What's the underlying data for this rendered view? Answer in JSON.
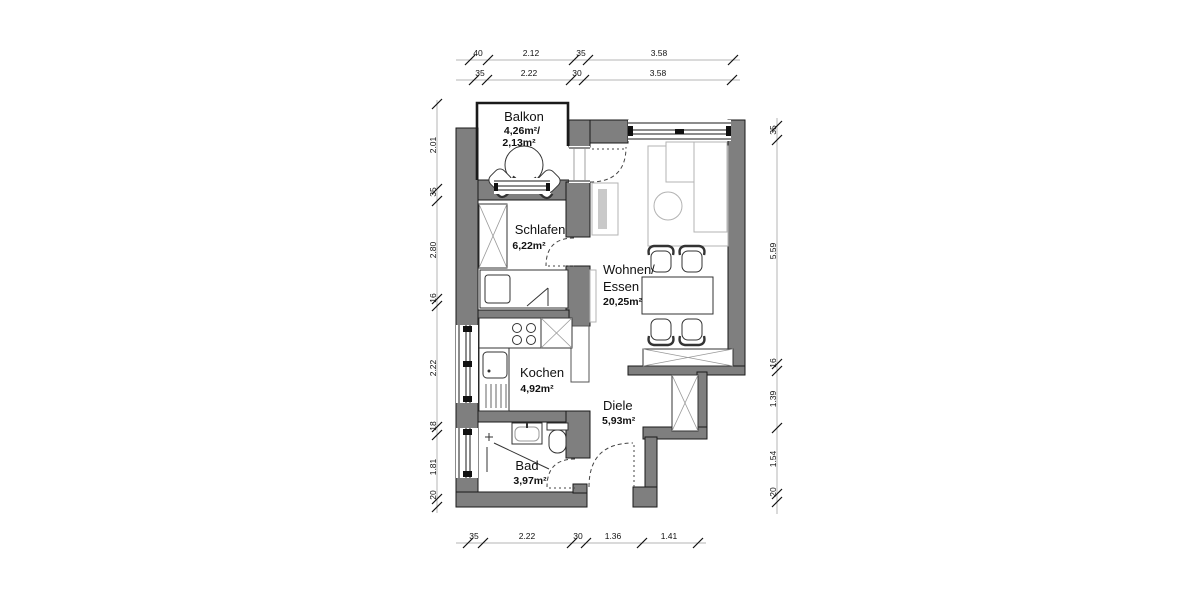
{
  "plan": {
    "type": "apartment-floor-plan",
    "rooms": {
      "balkon": {
        "name": "Balkon",
        "area": "4,26m²/",
        "area2": "2,13m²"
      },
      "schlafen": {
        "name": "Schlafen",
        "area": "6,22m²"
      },
      "wohnen": {
        "name": "Wohnen/",
        "name2": "Essen",
        "area": "20,25m²"
      },
      "kochen": {
        "name": "Kochen",
        "area": "4,92m²"
      },
      "diele": {
        "name": "Diele",
        "area": "5,93m²"
      },
      "bad": {
        "name": "Bad",
        "area": "3,97m²"
      }
    },
    "dimensions": {
      "top_row1": [
        "40",
        "2.12",
        "35",
        "3.58"
      ],
      "top_row2": [
        "35",
        "2.22",
        "30",
        "3.58"
      ],
      "left": [
        "2.01",
        "35",
        "2.80",
        "16",
        "2.22",
        "18",
        "1.81",
        "20"
      ],
      "right": [
        "35",
        "5.59",
        "16",
        "1.39",
        "1.54",
        "20"
      ],
      "bottom": [
        "35",
        "2.22",
        "30",
        "1.36",
        "1.41"
      ]
    },
    "colors": {
      "wall": "#7f7f7f",
      "outline": "#1a1a1a",
      "furniture_light": "#b3b3b3",
      "dimension_line": "#b4b4b4"
    }
  }
}
